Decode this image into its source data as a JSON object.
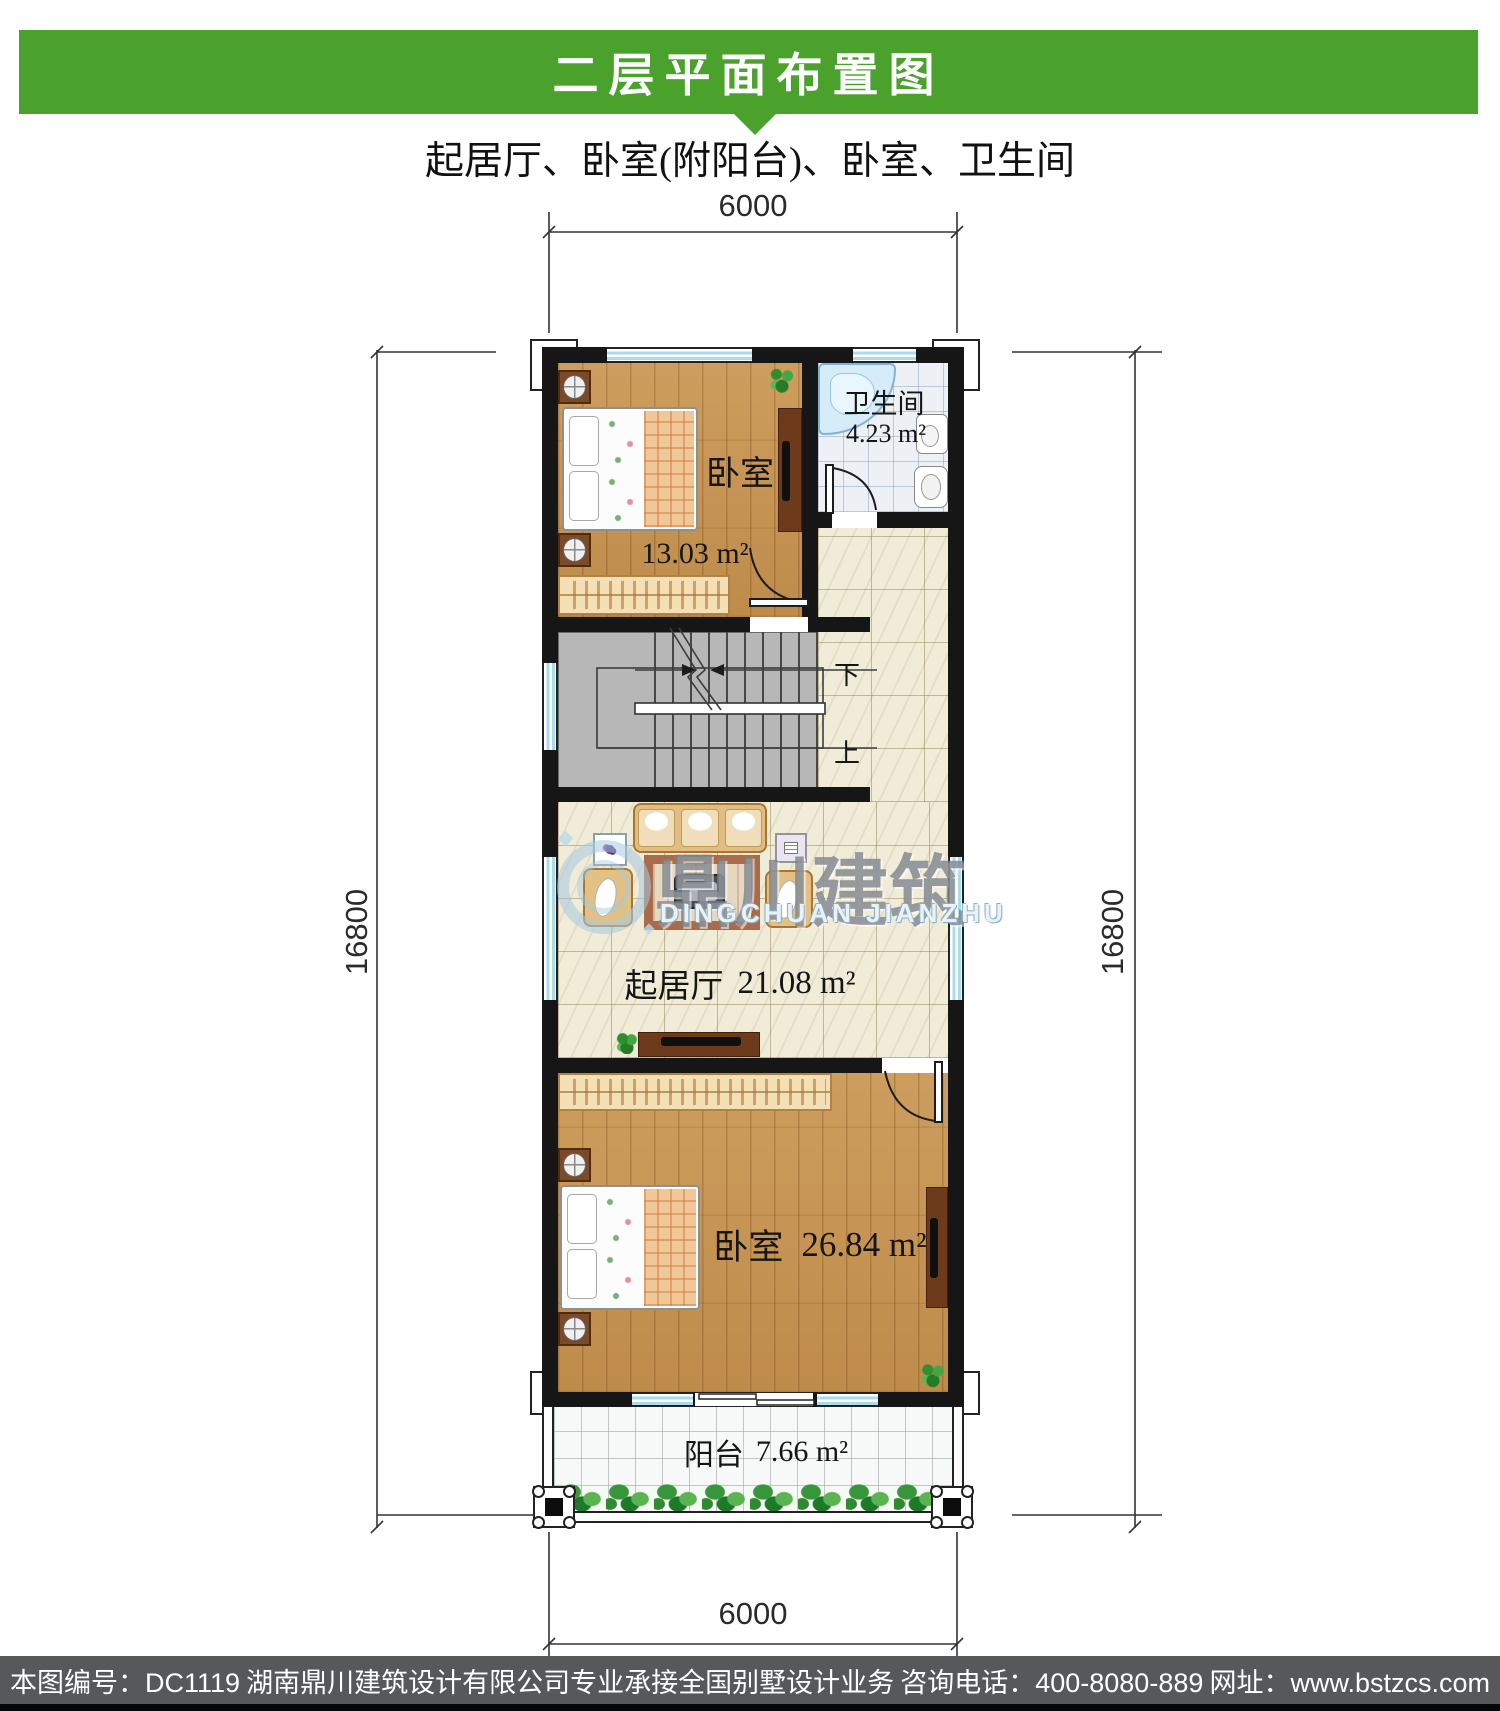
{
  "header": {
    "title": "二层平面布置图"
  },
  "subtitle": "起居厅、卧室(附阳台)、卧室、卫生间",
  "dimensions": {
    "top": "6000",
    "bottom": "6000",
    "left": "16800",
    "right": "16800"
  },
  "rooms": {
    "bedroom_top": {
      "name": "卧室",
      "area": "13.03 m²"
    },
    "bathroom": {
      "name": "卫生间",
      "area": "4.23 m²"
    },
    "living": {
      "name": "起居厅",
      "area": "21.08 m²"
    },
    "bedroom_bottom": {
      "name": "卧室",
      "area": "26.84 m²"
    },
    "balcony": {
      "name": "阳台",
      "area": "7.66 m²"
    }
  },
  "stairs": {
    "down_label": "下",
    "up_label": "上"
  },
  "watermark": {
    "logo_cn": "鼎川建筑",
    "logo_en": "DINGCHUAN JIANZHU"
  },
  "footer": {
    "drawing_no": "本图编号：DC1119",
    "company": "湖南鼎川建筑设计有限公司专业承接全国别墅设计业务",
    "phone": "咨询电话：400-8080-889",
    "website": "网址：www.bstzcs.com"
  },
  "colors": {
    "banner_green": "#4aa12b",
    "footer_bg": "#57585a",
    "wall_black": "#161616",
    "window_blue": "#a9dcec",
    "wood": "#c69350",
    "tile_cream": "#f1ecd8",
    "stair_gray": "#b7b7b7"
  }
}
